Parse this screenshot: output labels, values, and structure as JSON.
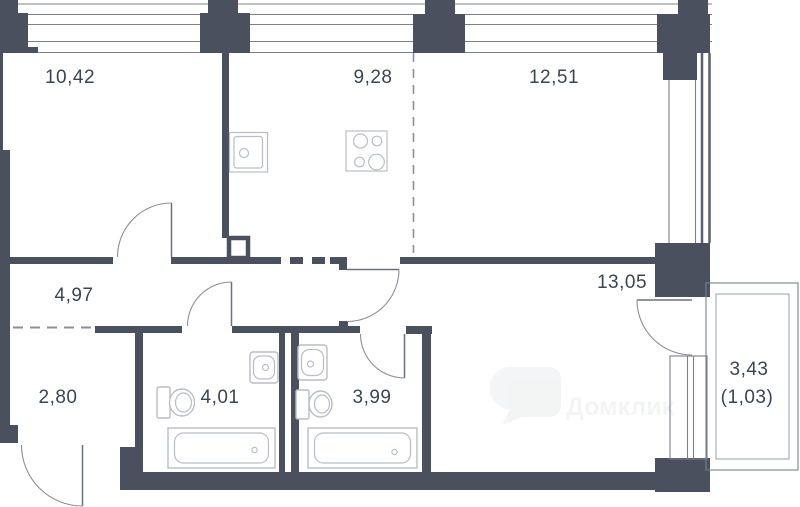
{
  "plan": {
    "type": "apartment-floor-plan",
    "rooms": [
      {
        "name": "bedroom",
        "area": "10,42"
      },
      {
        "name": "kitchen",
        "area": "9,28"
      },
      {
        "name": "living-zone",
        "area": "12,51"
      },
      {
        "name": "hallway",
        "area": "4,97"
      },
      {
        "name": "master-room",
        "area": "13,05"
      },
      {
        "name": "entry-hall",
        "area": "2,80"
      },
      {
        "name": "bathroom-1",
        "area": "4,01"
      },
      {
        "name": "bathroom-2",
        "area": "3,99"
      },
      {
        "name": "balcony",
        "area": "3,43"
      },
      {
        "name": "balcony-coeff",
        "area": "(1,03)"
      }
    ],
    "watermark": "Домклик",
    "colors": {
      "wall": "#4a505e",
      "frame_line": "#7b8089",
      "fixture_line": "#b9bdc4",
      "label_text": "#3d4452",
      "dash_line": "#8a8f99",
      "background": "#ffffff"
    }
  }
}
